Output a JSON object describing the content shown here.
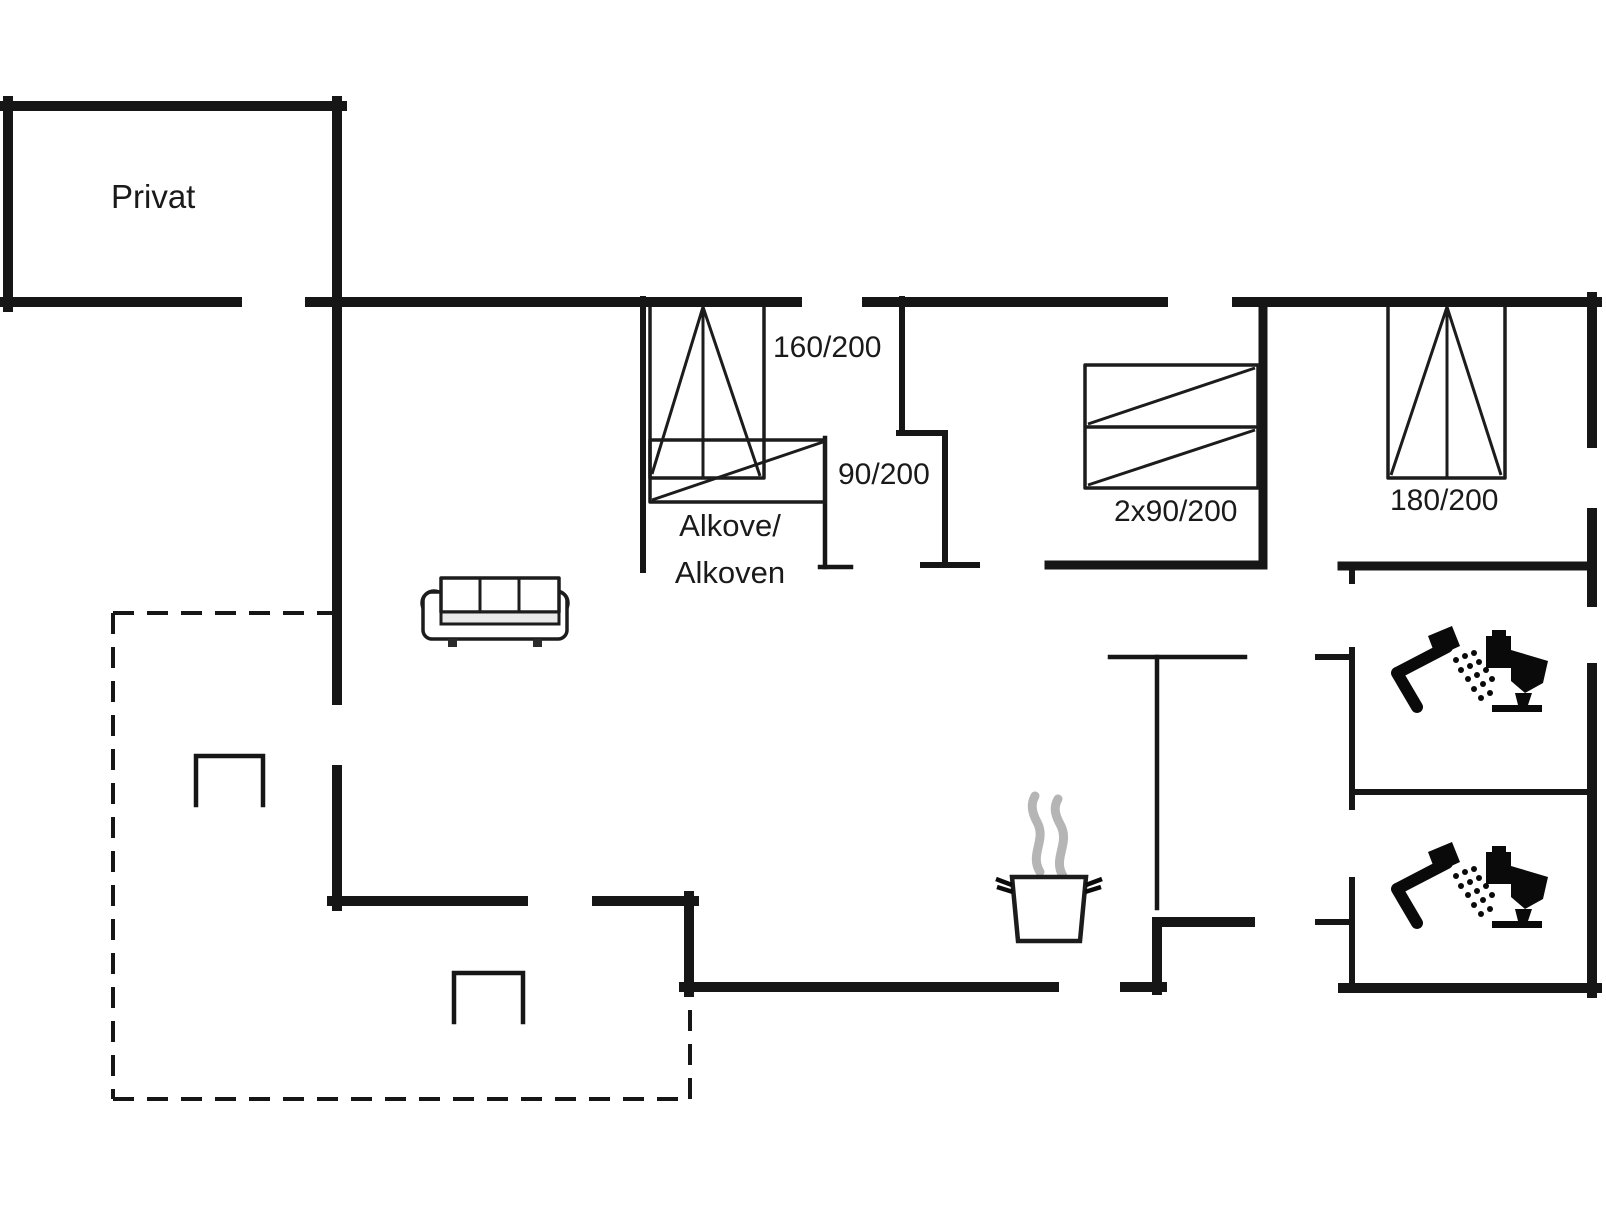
{
  "floor_plan": {
    "labels": {
      "private_room": "Privat",
      "alcove_bed_size": "160/200",
      "single_bed_size": "90/200",
      "alcove_name_line1": "Alkove/",
      "alcove_name_line2": "Alkoven",
      "bunk_bed_size": "2x90/200",
      "double_bed_size": "180/200"
    },
    "colors": {
      "wall": "#161616",
      "furniture_line": "#1c1c1c",
      "steam": "#b5b5b5",
      "icon": "#0a0a0a",
      "background": "#ffffff"
    },
    "icons": [
      {
        "name": "sofa-icon"
      },
      {
        "name": "cooking-pot-icon"
      },
      {
        "name": "steam-icon"
      },
      {
        "name": "shower-icon"
      },
      {
        "name": "toilet-icon"
      },
      {
        "name": "opening-step-icon"
      }
    ]
  }
}
